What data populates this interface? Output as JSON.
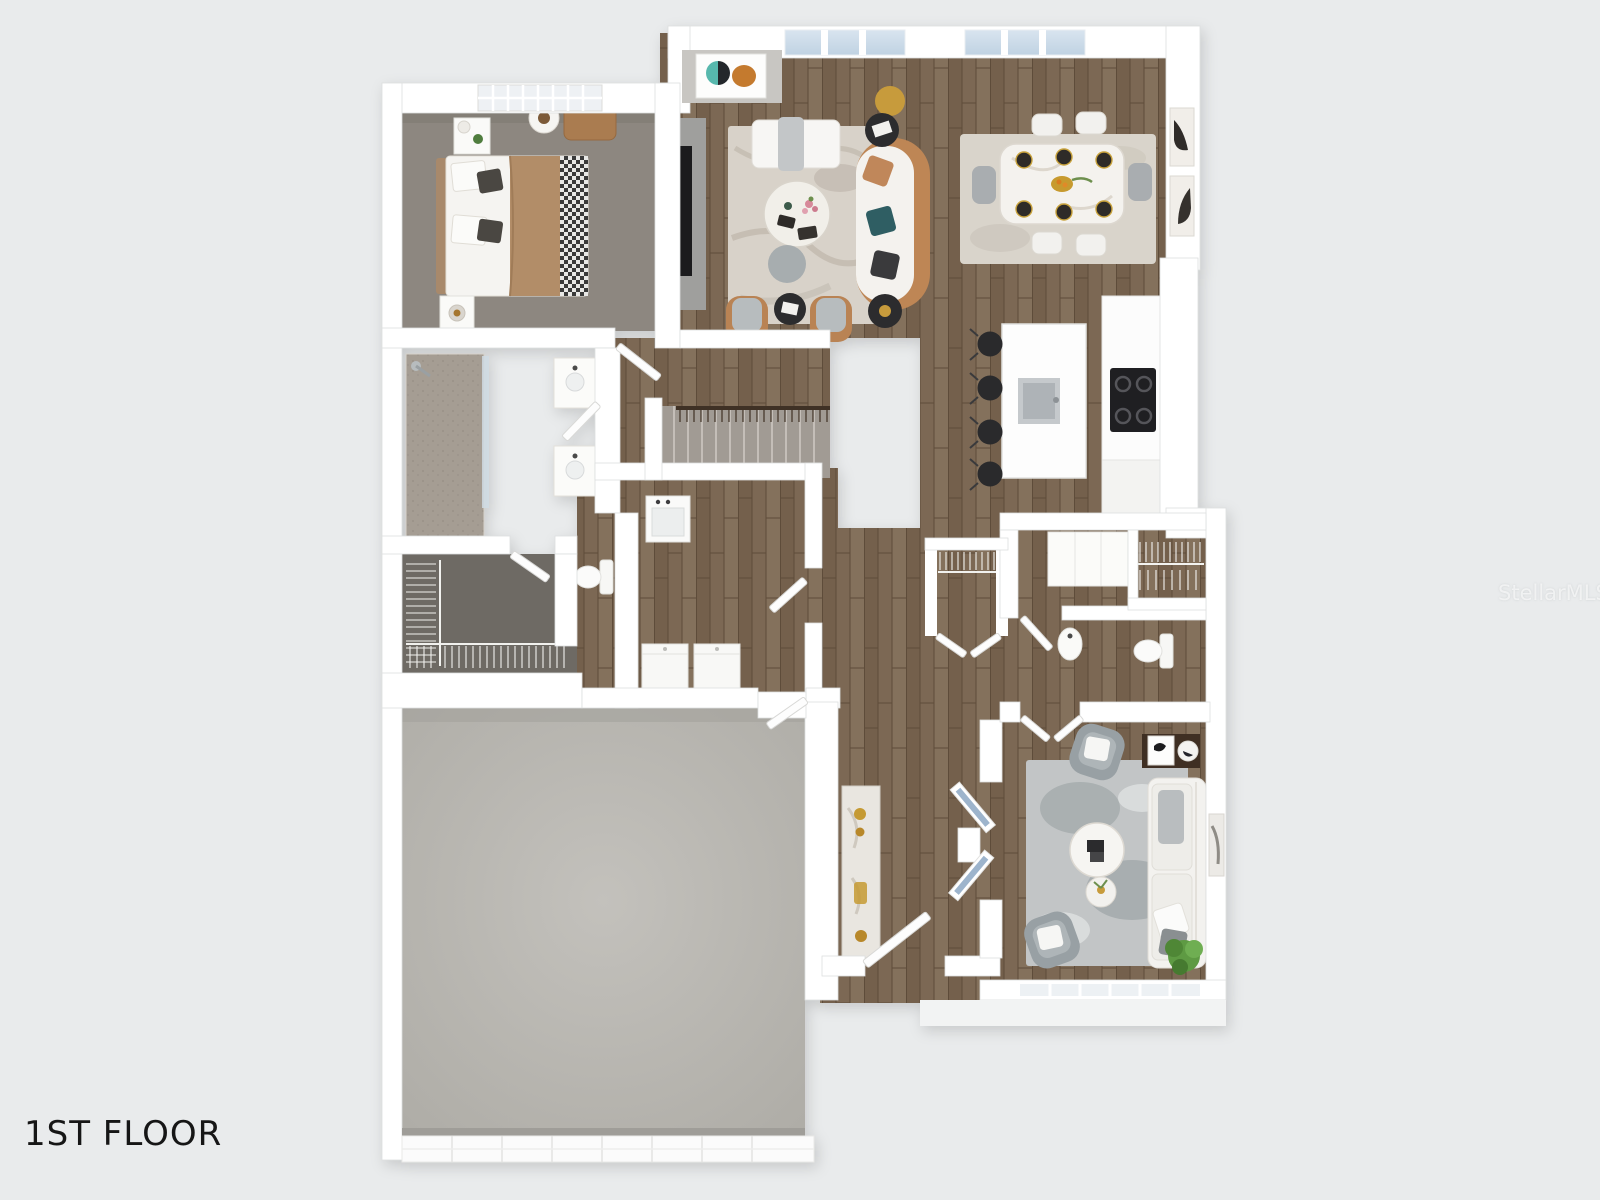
{
  "floorplan": {
    "title": "1ST FLOOR",
    "watermark": "StellarMLS",
    "colors": {
      "background": "#e9ebec",
      "wall": "#ffffff",
      "wood_floor": "#7c6854",
      "bedroom_carpet": "#8d8780",
      "closet_carpet": "#6e6a64",
      "stair_carpet": "#a19b94",
      "shower_tile": "#a59d93",
      "garage_concrete": "#b9b7b2",
      "window_glass": "#cfdeeb",
      "marble_rug": "#d8d2c9",
      "dining_rug": "#d9d4cb",
      "sitting_rug": "#c2c5c6",
      "leather_tan": "#be8655",
      "stool_black": "#2a2a2c",
      "railing_brown": "#3f3125",
      "accent_gold": "#c79b3c",
      "plant_green": "#5e9a43"
    }
  }
}
